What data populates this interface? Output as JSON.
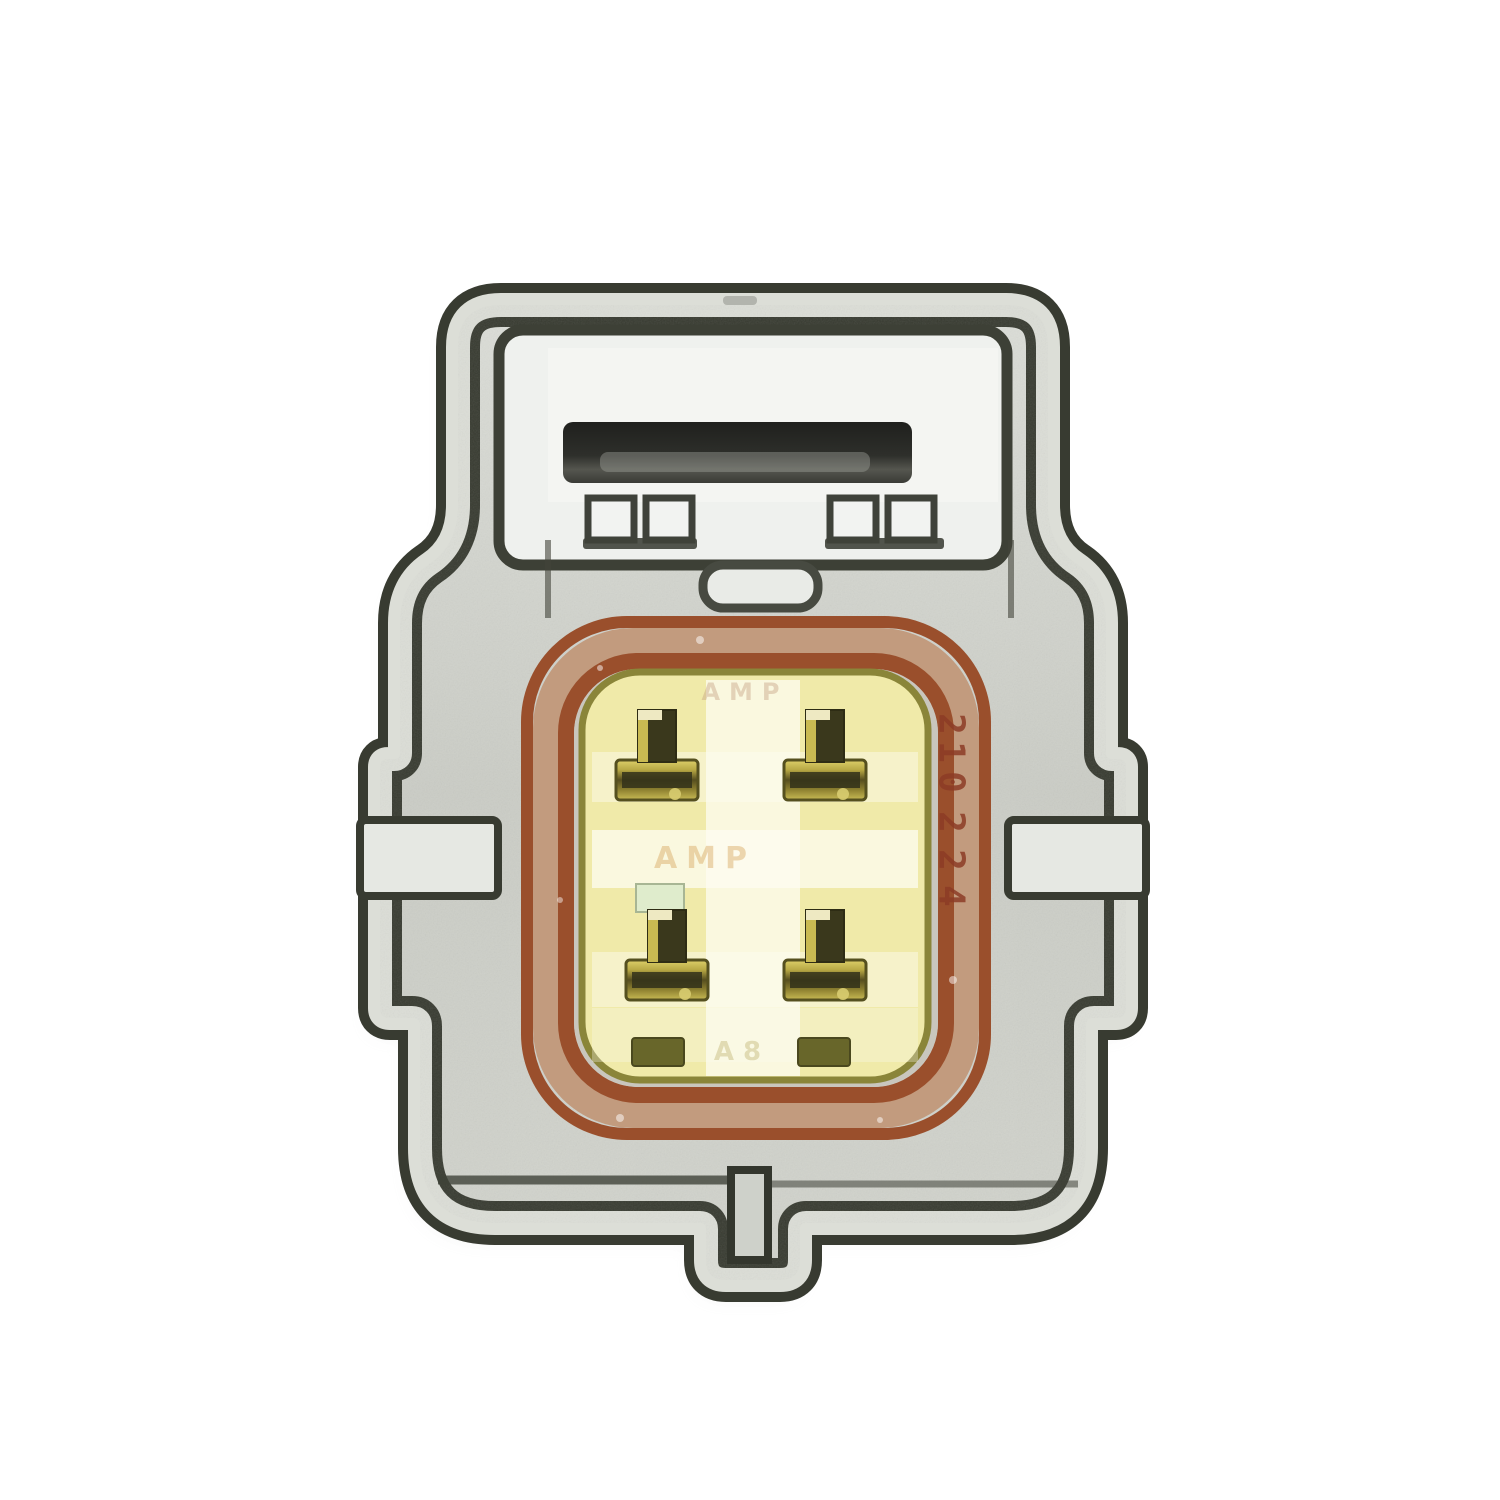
{
  "scene": {
    "subject": "Close-up photo of a gray 4-pin automotive electrical connector on a white background",
    "background_color": "#ffffff"
  },
  "connector": {
    "pins": {
      "count": "4",
      "layout": "2x2"
    },
    "markings": {
      "date_code": "210224",
      "brand_faint_top": "AMP",
      "brand_faint_center": "AMP",
      "cavity_faint_bottom": "A8"
    },
    "colors": {
      "housing_dark": "#383b31",
      "body_metal": "#cdcfc8",
      "body_light": "#dcded7",
      "latch_black": "#262723",
      "seal_edge": "#9a4f2c",
      "seal_band": "#c29b7e",
      "inner_silver": "#c9c6bd",
      "insert_yellow": "#f0eaa9",
      "insert_outline": "#8a8539",
      "pin_gold": "#b7a844",
      "pin_dark": "#3a381c",
      "slot_olive": "#68662a",
      "marking_brown": "#8d3c26"
    }
  }
}
